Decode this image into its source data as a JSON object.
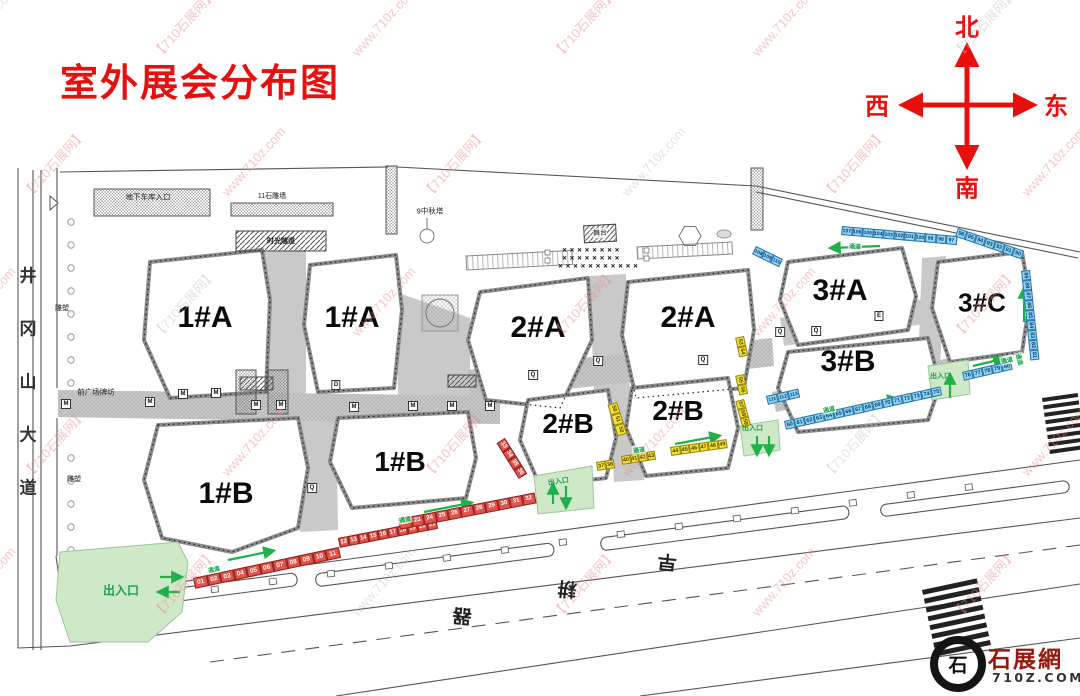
{
  "title": "室外展会分布图",
  "compass": {
    "north": "北",
    "west": "西",
    "east": "东",
    "south": "南"
  },
  "watermark": {
    "brand": "【710石展网】",
    "url": "www.710z.com"
  },
  "logo": {
    "seal_glyph": "石",
    "site_name": "石展網",
    "site_domain": "710Z.COM"
  },
  "roads": {
    "left_avenue": "井冈山大道",
    "bottom_road_chars": [
      "器",
      "耕",
      "早"
    ]
  },
  "map_labels": {
    "garage_entrance": "地下车库入口",
    "stone_wall": "11石雕墙",
    "time_tunnel": "时光隧道",
    "autumn_tower": "9中秋塔",
    "stage": "舞台",
    "front_archway": "前广场牌坊",
    "sculpture": "雕塑",
    "entrance_exit": "出入口",
    "passage": "通道"
  },
  "symbols": {
    "seat": "✕"
  },
  "walkway_markers": {
    "m": "M",
    "q": "Q",
    "d": "D",
    "e": "E"
  },
  "buildings": [
    {
      "id": "b1a_w",
      "label": "1#A"
    },
    {
      "id": "b1a_e",
      "label": "1#A"
    },
    {
      "id": "b2a_w",
      "label": "2#A"
    },
    {
      "id": "b2a_e",
      "label": "2#A"
    },
    {
      "id": "b3a",
      "label": "3#A"
    },
    {
      "id": "b3c",
      "label": "3#C"
    },
    {
      "id": "b3b",
      "label": "3#B"
    },
    {
      "id": "b2b_w",
      "label": "2#B"
    },
    {
      "id": "b2b_e",
      "label": "2#B"
    },
    {
      "id": "b1b_w",
      "label": "1#B"
    },
    {
      "id": "b1b_e",
      "label": "1#B"
    }
  ],
  "booth_strips": {
    "r1": {
      "color": "red",
      "numbers": [
        "01",
        "02",
        "03",
        "04",
        "05",
        "06",
        "07",
        "08",
        "09",
        "10",
        "11"
      ]
    },
    "r2": {
      "color": "red",
      "numbers": [
        "12",
        "13",
        "14",
        "15",
        "16",
        "17",
        "18",
        "19",
        "20",
        "21"
      ]
    },
    "r3": {
      "color": "red",
      "numbers": [
        "22",
        "23",
        "24",
        "25",
        "26",
        "27",
        "28",
        "29",
        "30",
        "31",
        "32"
      ]
    },
    "r4": {
      "color": "red",
      "numbers": [
        "33",
        "34",
        "35",
        "36"
      ]
    },
    "y1": {
      "color": "yellow",
      "numbers": [
        "37",
        "38"
      ]
    },
    "y2": {
      "color": "yellow",
      "numbers": [
        "40",
        "41",
        "42",
        "43"
      ]
    },
    "y3": {
      "color": "yellow",
      "numbers": [
        "44",
        "45",
        "46",
        "47",
        "48",
        "49"
      ]
    },
    "y4": {
      "color": "yellow",
      "numbers": [
        "50",
        "51",
        "52"
      ]
    },
    "y5": {
      "color": "yellow",
      "numbers": [
        "53",
        "54"
      ]
    },
    "y6": {
      "color": "yellow",
      "numbers": [
        "55",
        "56"
      ]
    },
    "y7": {
      "color": "yellow",
      "numbers": [
        "57",
        "58",
        "59"
      ]
    },
    "bl1": {
      "color": "blue",
      "numbers": [
        "60",
        "61",
        "62",
        "63",
        "64",
        "65",
        "66",
        "67",
        "68",
        "69",
        "70",
        "71",
        "72",
        "73",
        "74",
        "75"
      ]
    },
    "bl2": {
      "color": "blue",
      "numbers": [
        "76",
        "77",
        "78",
        "79",
        "80"
      ]
    },
    "bl3": {
      "color": "blue",
      "numbers": [
        "89",
        "88",
        "87",
        "86",
        "85",
        "84",
        "83",
        "82",
        "81"
      ]
    },
    "bl4": {
      "color": "blue",
      "numbers": [
        "96",
        "95",
        "94",
        "93",
        "92",
        "91",
        "90"
      ]
    },
    "bl5": {
      "color": "blue",
      "numbers": [
        "107",
        "106",
        "105",
        "104",
        "103",
        "102",
        "101",
        "100",
        "99",
        "98",
        "97"
      ]
    },
    "bl6": {
      "color": "blue",
      "numbers": [
        "108",
        "109",
        "110"
      ]
    },
    "bl7": {
      "color": "blue",
      "numbers": [
        "111",
        "112",
        "113"
      ]
    }
  },
  "colors": {
    "accent_red": "#e8100c",
    "booth_red": "#e2544b",
    "booth_yellow": "#f4e534",
    "booth_blue": "#93d5ef",
    "passage_green": "#17a34a",
    "logo_red": "#97180d"
  }
}
